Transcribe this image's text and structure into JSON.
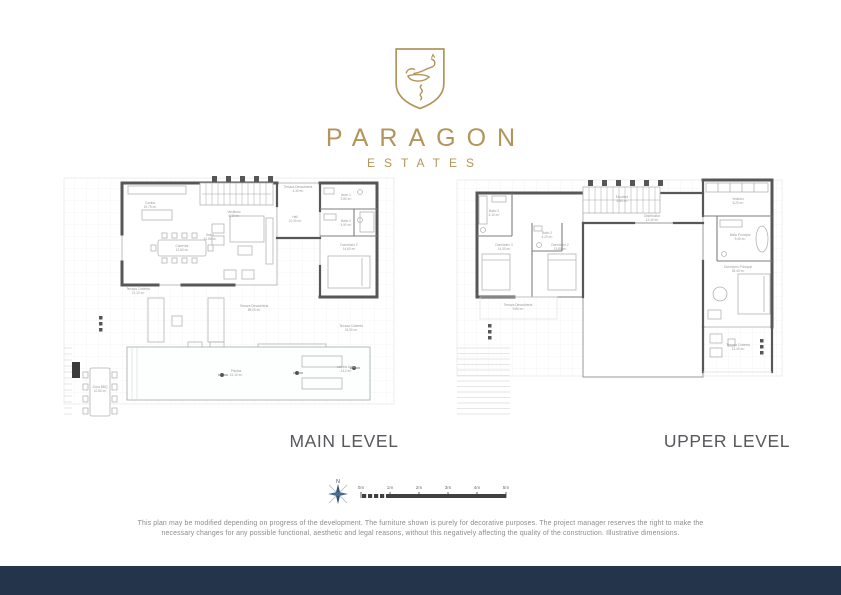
{
  "brand": {
    "wordmark": "PARAGON",
    "tagline": "ESTATES"
  },
  "levels": {
    "main_label": "MAIN LEVEL",
    "upper_label": "UPPER LEVEL"
  },
  "compass": {
    "north_label": "N"
  },
  "scalebar": {
    "ticks": [
      "0m",
      "1m",
      "2m",
      "3m",
      "4m",
      "5m"
    ]
  },
  "disclaimer": {
    "line1": "This plan may be modified depending on progress of the development. The furniture shown is purely for decorative purposes. The project manager reserves the right to make the",
    "line2": "necessary changes for any possible functional, aesthetic and legal reasons, without this negatively affecting the quality of the construction. Illustrative dimensions."
  },
  "colors": {
    "gold": "#b3955c",
    "navy": "#24344a"
  },
  "plans": {
    "main": {
      "rooms": [
        {
          "name": "Vestíbulo",
          "area": "6,40 m²"
        },
        {
          "name": "Cocina",
          "area": "19,75 m²"
        },
        {
          "name": "Comedor",
          "area": "12,60 m²"
        },
        {
          "name": "Salón",
          "area": "41,80 m²"
        },
        {
          "name": "Hall",
          "area": "10,30 m²"
        },
        {
          "name": "Terraza Descubierta",
          "area": "4,30 m²"
        },
        {
          "name": "Aseo 1",
          "area": "2,80 m²"
        },
        {
          "name": "Baño 2",
          "area": "4,90 m²"
        },
        {
          "name": "Dormitorio 2",
          "area": "14,60 m²"
        },
        {
          "name": "Terraza Cubierta",
          "area": "21,10 m²"
        },
        {
          "name": "Terraza Descubierta",
          "area": "89,00 m²"
        },
        {
          "name": "Terraza Cubierta",
          "area": "24,90 m²"
        },
        {
          "name": "Piscina",
          "area": "41,10 m²"
        },
        {
          "name": "Lámina Agua",
          "area": "14,2 m²"
        },
        {
          "name": "Zona BBQ",
          "area": "10,50 m²"
        }
      ]
    },
    "upper": {
      "rooms": [
        {
          "name": "Baño 3",
          "area": "4,10 m²"
        },
        {
          "name": "Dormitorio 3",
          "area": "14,30 m²"
        },
        {
          "name": "Baño 2",
          "area": "4,20 m²"
        },
        {
          "name": "Dormitorio 2",
          "area": "13,80 m²"
        },
        {
          "name": "Escalera",
          "area": "6,80 m²"
        },
        {
          "name": "Distribuidor",
          "area": "12,40 m²"
        },
        {
          "name": "Vestidor",
          "area": "6,20 m²"
        },
        {
          "name": "Baño Principal",
          "area": "9,40 m²"
        },
        {
          "name": "Dormitorio Principal",
          "area": "28,40 m²"
        },
        {
          "name": "Terraza Cubierta",
          "area": "12,40 m²"
        },
        {
          "name": "Terraza Descubierta",
          "area": "9,80 m²"
        }
      ]
    }
  }
}
